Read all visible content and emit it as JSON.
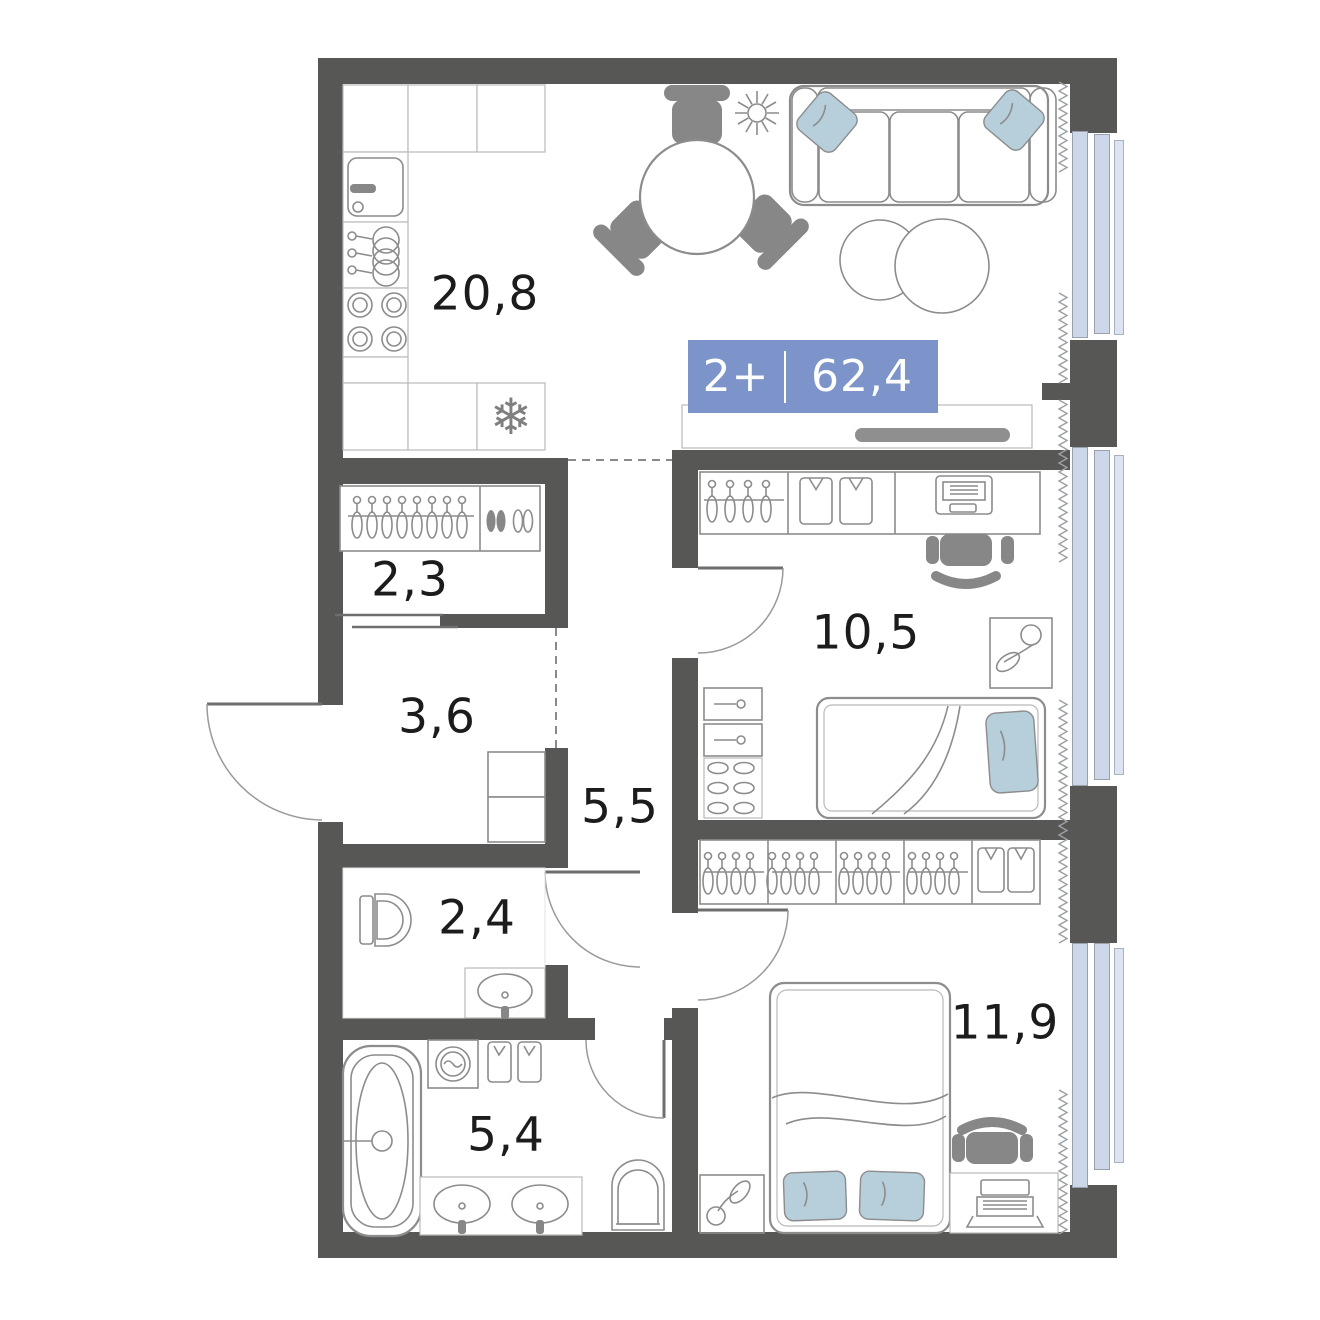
{
  "plan": {
    "badge": {
      "rooms_label": "2+",
      "total_area": "62,4"
    },
    "rooms": [
      {
        "key": "kitchen-living",
        "area": "20,8"
      },
      {
        "key": "wardrobe",
        "area": "2,3"
      },
      {
        "key": "hallway",
        "area": "3,6"
      },
      {
        "key": "corridor",
        "area": "5,5"
      },
      {
        "key": "bedroom-1",
        "area": "10,5"
      },
      {
        "key": "wc",
        "area": "2,4"
      },
      {
        "key": "bathroom",
        "area": "5,4"
      },
      {
        "key": "bedroom-2",
        "area": "11,9"
      }
    ],
    "colors": {
      "wall": "#575756",
      "furniture_line": "#8c8c8c",
      "dark_furniture": "#878787",
      "window_glass": "#cdd7ea",
      "window_glass_outer": "#dce3f2",
      "badge_bg": "#7d94ca",
      "textile_blue": "#b7cedb",
      "label_text": "#1c1c1c"
    }
  }
}
